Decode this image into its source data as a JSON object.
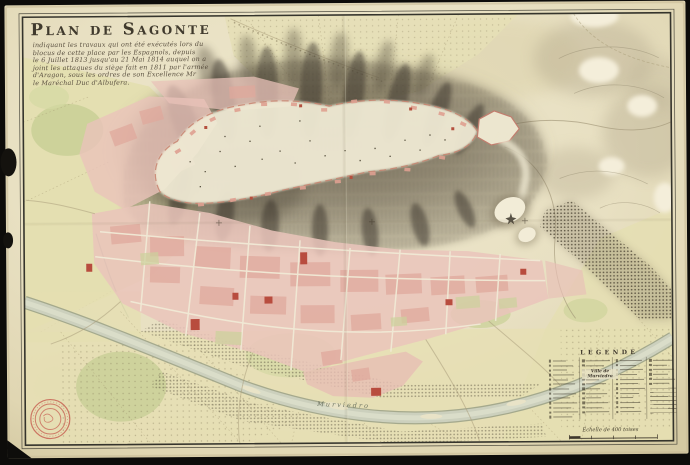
{
  "title_block": {
    "title": "Plan de Sagonte",
    "subtitle_lines": [
      "indiquant les travaux qui ont été exécutés lors du",
      "blocus de cette place par les Espagnols, depuis",
      "le 6 Juillet 1813 jusqu'au 21 Mai 1814 auquel on a",
      "joint les attaques du siège fait en 1811 par l'armée",
      "d'Aragon, sous les ordres de son Excellence Mr",
      "le Maréchal Duc d'Albufera."
    ]
  },
  "map_labels": {
    "river": "Murviedro"
  },
  "legend": {
    "title": "LEGENDE",
    "ville_subheader": "Ville de Murviedro",
    "scale_caption": "Echelle de 400 toises",
    "columns_rows": [
      13,
      12,
      12,
      6
    ]
  },
  "colors": {
    "background": "#0d0c0a",
    "paper": "#e9e2c6",
    "ink": "#3f382c",
    "town_pink": "#eac3ba",
    "accent_red": "#b84c3e",
    "hill_sepia": "#6e6450",
    "river": "#ccd0bd",
    "field_green": "#c9d096",
    "stamp_red": "#c65a4e"
  }
}
